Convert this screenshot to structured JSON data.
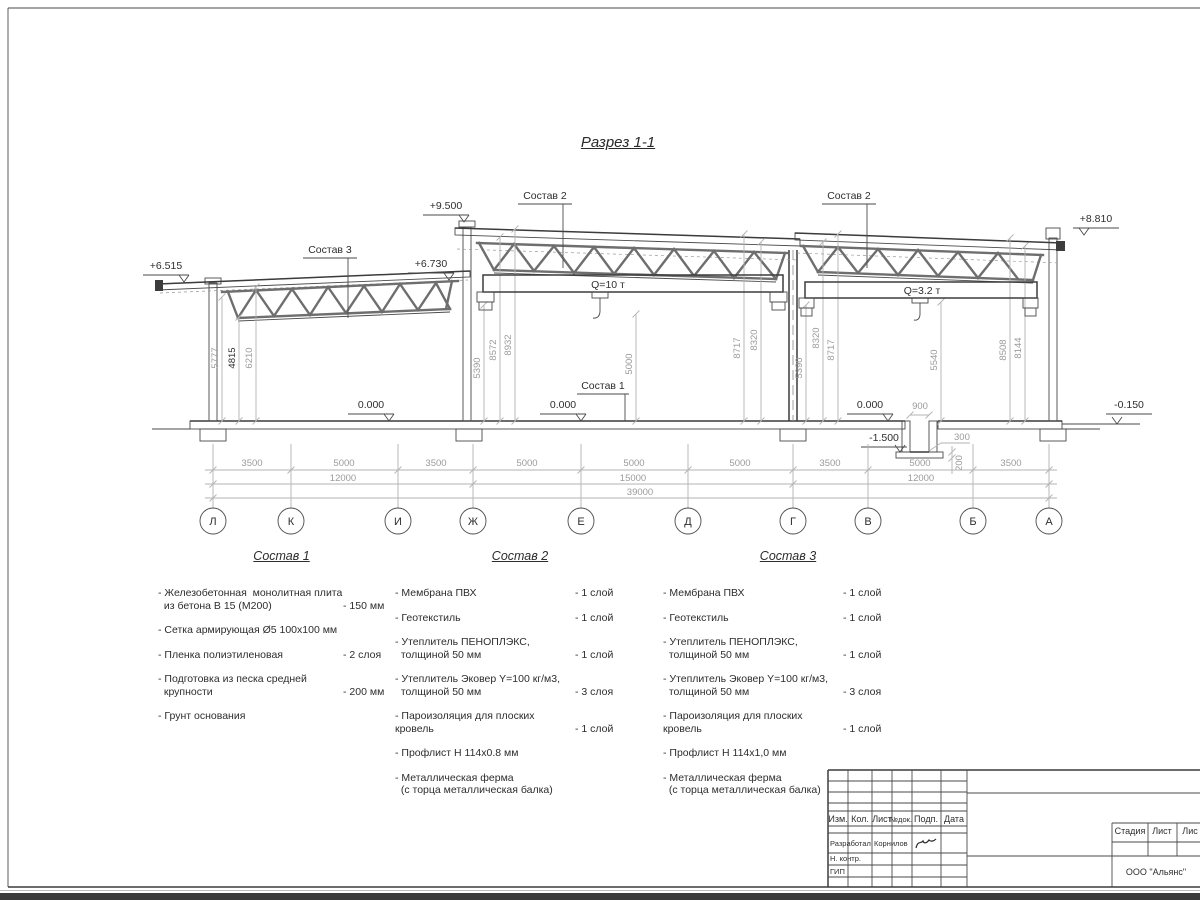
{
  "drawing_title": "Разрез 1-1",
  "section": {
    "elevation_marks": [
      {
        "label": "+9.500"
      },
      {
        "label": "+6.515"
      },
      {
        "label": "+6.730"
      },
      {
        "label": "+8.810"
      },
      {
        "label": "0.000"
      },
      {
        "label": "0.000"
      },
      {
        "label": "0.000"
      },
      {
        "label": "-1.500"
      },
      {
        "label": "-0.150"
      }
    ],
    "crane_labels": [
      "Q=10 т",
      "Q=3.2 т"
    ],
    "leader_labels": [
      "Состав 3",
      "Состав 2",
      "Состав 2",
      "Состав 1"
    ],
    "vertical_dims": [
      "5777",
      "4815",
      "6210",
      "5390",
      "8572",
      "8932",
      "5000",
      "8717",
      "8320",
      "5390",
      "8320",
      "8717",
      "5540",
      "8508",
      "8144"
    ],
    "pit_dims": {
      "width": "900",
      "wall": "300",
      "slab": "200"
    }
  },
  "dimensions": {
    "spans": [
      "3500",
      "5000",
      "3500",
      "5000",
      "5000",
      "5000",
      "3500",
      "5000",
      "3500"
    ],
    "groups": [
      "12000",
      "15000",
      "12000"
    ],
    "total": "39000"
  },
  "axes": [
    "Л",
    "К",
    "И",
    "Ж",
    "Е",
    "Д",
    "Г",
    "В",
    "Б",
    "А"
  ],
  "compositions": [
    {
      "title": "Состав 1",
      "items": [
        {
          "name": "- Железобетонная  монолитная плита\n  из бетона В 15 (М200)",
          "qty": "- 150 мм"
        },
        {
          "name": "- Сетка армирующая Ø5 100x100 мм",
          "qty": ""
        },
        {
          "name": "- Пленка полиэтиленовая",
          "qty": "-  2 слоя"
        },
        {
          "name": "- Подготовка из песка средней\n  крупности",
          "qty": "- 200 мм"
        },
        {
          "name": "- Грунт основания",
          "qty": ""
        }
      ]
    },
    {
      "title": "Состав 2",
      "items": [
        {
          "name": "- Мембрана ПВХ",
          "qty": "- 1 слой"
        },
        {
          "name": "- Геотекстиль",
          "qty": "- 1 слой"
        },
        {
          "name": "- Утеплитель ПЕНОПЛЭКС,\n  толщиной 50 мм",
          "qty": "- 1 слой"
        },
        {
          "name": "- Утеплитель Эковер Y=100 кг/м3,\n  толщиной 50 мм",
          "qty": "- 3 слоя"
        },
        {
          "name": "- Пароизоляция для плоских кровель",
          "qty": "- 1 слой"
        },
        {
          "name": "- Профлист Н 114х0.8 мм",
          "qty": ""
        },
        {
          "name": "- Металлическая ферма\n  (с торца металлическая балка)",
          "qty": ""
        }
      ]
    },
    {
      "title": "Состав 3",
      "items": [
        {
          "name": "- Мембрана ПВХ",
          "qty": "- 1 слой"
        },
        {
          "name": "- Геотекстиль",
          "qty": "- 1 слой"
        },
        {
          "name": "- Утеплитель ПЕНОПЛЭКС,\n  толщиной 50 мм",
          "qty": "- 1 слой"
        },
        {
          "name": "- Утеплитель Эковер Y=100 кг/м3,\n  толщиной 50 мм",
          "qty": "- 3 слоя"
        },
        {
          "name": "- Пароизоляция для плоских кровель",
          "qty": "- 1 слой"
        },
        {
          "name": "- Профлист Н 114х1,0 мм",
          "qty": ""
        },
        {
          "name": "- Металлическая ферма\n  (с торца металлическая балка)",
          "qty": ""
        }
      ]
    }
  ],
  "titleblock": {
    "change_cols": [
      "Изм.",
      "Кол.",
      "Лист",
      "№док.",
      "Подп.",
      "Дата"
    ],
    "signature_rows": [
      {
        "role": "Разработал",
        "name": "Корнилов"
      },
      {
        "role": "Н. контр.",
        "name": ""
      },
      {
        "role": "ГИП",
        "name": ""
      }
    ],
    "stage_cols": [
      "Стадия",
      "Лист",
      "Лис"
    ],
    "company": "ООО \"Альянс\""
  }
}
